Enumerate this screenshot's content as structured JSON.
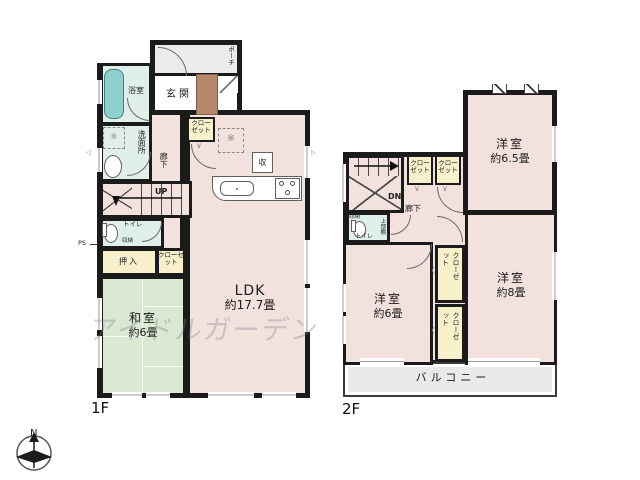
{
  "floors": {
    "f1": {
      "label": "1F",
      "rooms": {
        "porch": "ポーチ",
        "genkan": "玄関",
        "bath": "浴室",
        "washroom": "洗面所",
        "corridor": "廊下",
        "up": "UP",
        "closet_entry": "クローゼット",
        "toilet": "トイレ",
        "toilet_storage": "収納",
        "oshiire": "押入",
        "closet_washitsu": "クローゼット",
        "washitsu_name": "和室",
        "washitsu_size": "約6畳",
        "ldk_name": "LDK",
        "ldk_size": "約17.7畳",
        "kitchen_storage": "収",
        "ps": "PS"
      }
    },
    "f2": {
      "label": "2F",
      "rooms": {
        "dn": "DN",
        "corridor": "廊下",
        "closet_a": "クローゼット",
        "closet_b": "クローゼット",
        "closet_c": "クローゼット",
        "closet_d": "クローゼット",
        "toilet": "トイレ",
        "toilet_storage": "収納",
        "toilet_shelf": "上部棚",
        "room65_name": "洋室",
        "room65_size": "約6.5畳",
        "room8_name": "洋室",
        "room8_size": "約8畳",
        "room6_name": "洋室",
        "room6_size": "約6畳",
        "balcony": "バルコニー"
      }
    }
  },
  "compass": {
    "north": "N"
  },
  "watermark": {
    "text": "アイドルガーデン"
  },
  "marks": {
    "laundry": "※",
    "fridge": "※",
    "chevron_down": "∨",
    "chevron_left": "〈",
    "vent_left": "◁",
    "vent_right": "▷"
  },
  "colors": {
    "wall": "#1b1b1b",
    "room_pink": "#f2e1dd",
    "tatami_green": "#d9e9d2",
    "wet_aqua": "#e0efe9",
    "closet_yellow": "#f7f0cb",
    "porch_gray": "#ebebeb",
    "tub_teal": "#8fd0cd",
    "step_brown": "#b5886b"
  }
}
